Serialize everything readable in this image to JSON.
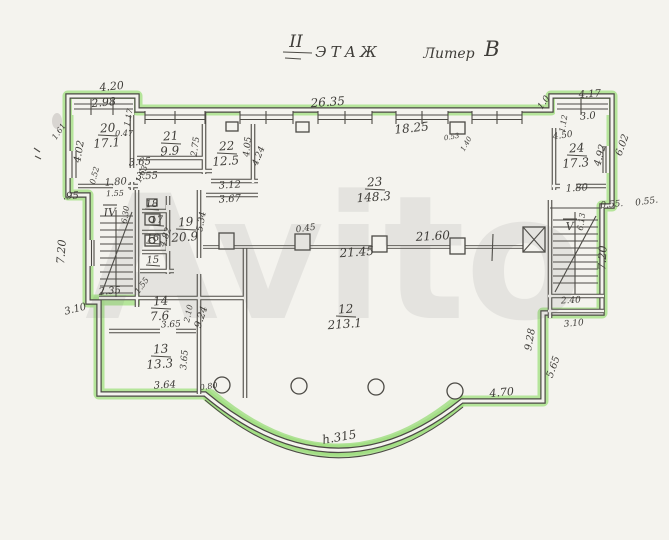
{
  "title": {
    "floor_numeral": "II",
    "floor_word": "ЭТАЖ",
    "liter_word": "Литер",
    "liter_value": "В"
  },
  "watermark": "Avito",
  "colors": {
    "highlight": "#a9e28b",
    "ink": "#4c4a45",
    "paper": "#f4f3ee"
  },
  "rooms": [
    {
      "number": "20",
      "area": "17.1",
      "x": 108,
      "y": 132
    },
    {
      "number": "21",
      "area": "9.9",
      "x": 171,
      "y": 140
    },
    {
      "number": "22",
      "area": "12.5",
      "x": 227,
      "y": 150
    },
    {
      "number": "23",
      "area": "148.3",
      "x": 375,
      "y": 186
    },
    {
      "number": "24",
      "area": "17.3",
      "x": 577,
      "y": 152
    },
    {
      "number": "19",
      "area": "20.9",
      "x": 186,
      "y": 226
    },
    {
      "number": "12",
      "area": "213.1",
      "x": 346,
      "y": 313
    },
    {
      "number": "14",
      "area": "7.6",
      "x": 161,
      "y": 305
    },
    {
      "number": "13",
      "area": "13.3",
      "x": 161,
      "y": 353
    }
  ],
  "small_rooms": [
    {
      "number": "18",
      "x": 152,
      "y": 207
    },
    {
      "number": "17",
      "x": 157,
      "y": 223
    },
    {
      "number": "16",
      "x": 153,
      "y": 241
    },
    {
      "number": "15",
      "x": 153,
      "y": 263
    }
  ],
  "stairs": [
    {
      "label": "IV",
      "x": 110,
      "y": 216
    },
    {
      "label": "V",
      "x": 570,
      "y": 230
    }
  ],
  "dims": [
    {
      "t": "4.20",
      "x": 112,
      "y": 90,
      "r": -6,
      "s": 11
    },
    {
      "t": "2.98",
      "x": 104,
      "y": 106,
      "r": -5,
      "s": 11
    },
    {
      "t": "1.17",
      "x": 131,
      "y": 118,
      "r": -78,
      "s": 8
    },
    {
      "t": "0.47",
      "x": 124,
      "y": 136,
      "r": 0,
      "s": 8
    },
    {
      "t": "4.02",
      "x": 82,
      "y": 152,
      "r": -80,
      "s": 10
    },
    {
      "t": "1.61",
      "x": 61,
      "y": 133,
      "r": -55,
      "s": 8
    },
    {
      "t": "0.52",
      "x": 97,
      "y": 176,
      "r": -75,
      "s": 8
    },
    {
      "t": "1.80",
      "x": 116,
      "y": 185,
      "r": -4,
      "s": 10
    },
    {
      "t": ".95",
      "x": 71,
      "y": 199,
      "r": -3,
      "s": 10
    },
    {
      "t": "3.65",
      "x": 140,
      "y": 165,
      "r": -3,
      "s": 10
    },
    {
      "t": "3.55",
      "x": 147,
      "y": 179,
      "r": -3,
      "s": 10
    },
    {
      "t": "1.55",
      "x": 115,
      "y": 196,
      "r": -2,
      "s": 8
    },
    {
      "t": "1.63",
      "x": 144,
      "y": 175,
      "r": -65,
      "s": 8
    },
    {
      "t": "2.75",
      "x": 198,
      "y": 147,
      "r": -82,
      "s": 9
    },
    {
      "t": "3.12",
      "x": 230,
      "y": 188,
      "r": -3,
      "s": 10
    },
    {
      "t": "3.67",
      "x": 230,
      "y": 202,
      "r": -3,
      "s": 10
    },
    {
      "t": "4.05",
      "x": 250,
      "y": 147,
      "r": -84,
      "s": 9
    },
    {
      "t": "4.24",
      "x": 261,
      "y": 157,
      "r": -68,
      "s": 9
    },
    {
      "t": "26.35",
      "x": 328,
      "y": 106,
      "r": -4,
      "s": 12
    },
    {
      "t": "18.25",
      "x": 412,
      "y": 132,
      "r": -6,
      "s": 12
    },
    {
      "t": "0.53",
      "x": 452,
      "y": 139,
      "r": -10,
      "s": 7
    },
    {
      "t": "1.40",
      "x": 468,
      "y": 145,
      "r": -60,
      "s": 7
    },
    {
      "t": "1.0",
      "x": 546,
      "y": 104,
      "r": -55,
      "s": 9
    },
    {
      "t": "4.17",
      "x": 590,
      "y": 97,
      "r": -3,
      "s": 10
    },
    {
      "t": "3.0",
      "x": 588,
      "y": 119,
      "r": -5,
      "s": 10
    },
    {
      "t": "1.12",
      "x": 566,
      "y": 124,
      "r": -80,
      "s": 8
    },
    {
      "t": "4.50",
      "x": 563,
      "y": 138,
      "r": -8,
      "s": 9
    },
    {
      "t": "4.92",
      "x": 603,
      "y": 156,
      "r": -75,
      "s": 10
    },
    {
      "t": "6.02",
      "x": 625,
      "y": 146,
      "r": -70,
      "s": 10
    },
    {
      "t": "1.80",
      "x": 577,
      "y": 191,
      "r": -3,
      "s": 10
    },
    {
      "t": "0.55.",
      "x": 612,
      "y": 207,
      "r": -5,
      "s": 9
    },
    {
      "t": "0.55.",
      "x": 647,
      "y": 204,
      "r": -8,
      "s": 9
    },
    {
      "t": "5.34",
      "x": 204,
      "y": 222,
      "r": -80,
      "s": 9
    },
    {
      "t": "0.45",
      "x": 306,
      "y": 231,
      "r": -8,
      "s": 9
    },
    {
      "t": "21.60",
      "x": 433,
      "y": 240,
      "r": -3,
      "s": 12
    },
    {
      "t": "21.45",
      "x": 357,
      "y": 256,
      "r": -4,
      "s": 12
    },
    {
      "t": "4.82",
      "x": 168,
      "y": 238,
      "r": -70,
      "s": 9
    },
    {
      "t": "6.30",
      "x": 128,
      "y": 215,
      "r": -82,
      "s": 8
    },
    {
      "t": "7.20",
      "x": 65,
      "y": 252,
      "r": -86,
      "s": 11
    },
    {
      "t": "1.55",
      "x": 144,
      "y": 287,
      "r": -55,
      "s": 8
    },
    {
      "t": "2.35",
      "x": 110,
      "y": 294,
      "r": -4,
      "s": 10
    },
    {
      "t": "3.10",
      "x": 76,
      "y": 312,
      "r": -14,
      "s": 10
    },
    {
      "t": "3.65",
      "x": 171,
      "y": 327,
      "r": -3,
      "s": 9
    },
    {
      "t": "2.10",
      "x": 191,
      "y": 314,
      "r": -78,
      "s": 8
    },
    {
      "t": "9.24",
      "x": 204,
      "y": 318,
      "r": -72,
      "s": 10
    },
    {
      "t": "3.65",
      "x": 187,
      "y": 360,
      "r": -85,
      "s": 9
    },
    {
      "t": "3.64",
      "x": 165,
      "y": 388,
      "r": -3,
      "s": 10
    },
    {
      "t": "0.80",
      "x": 209,
      "y": 389,
      "r": -8,
      "s": 8
    },
    {
      "t": "h.315",
      "x": 340,
      "y": 441,
      "r": -10,
      "s": 12
    },
    {
      "t": "4.70",
      "x": 502,
      "y": 396,
      "r": -5,
      "s": 11
    },
    {
      "t": "9.28",
      "x": 533,
      "y": 340,
      "r": -80,
      "s": 10
    },
    {
      "t": "5.65",
      "x": 556,
      "y": 368,
      "r": -70,
      "s": 10
    },
    {
      "t": "2.40",
      "x": 571,
      "y": 303,
      "r": -3,
      "s": 9
    },
    {
      "t": "3.10",
      "x": 574,
      "y": 326,
      "r": -5,
      "s": 9
    },
    {
      "t": "6.13",
      "x": 584,
      "y": 222,
      "r": -82,
      "s": 8
    },
    {
      "t": "7.20",
      "x": 606,
      "y": 258,
      "r": -87,
      "s": 11
    }
  ]
}
